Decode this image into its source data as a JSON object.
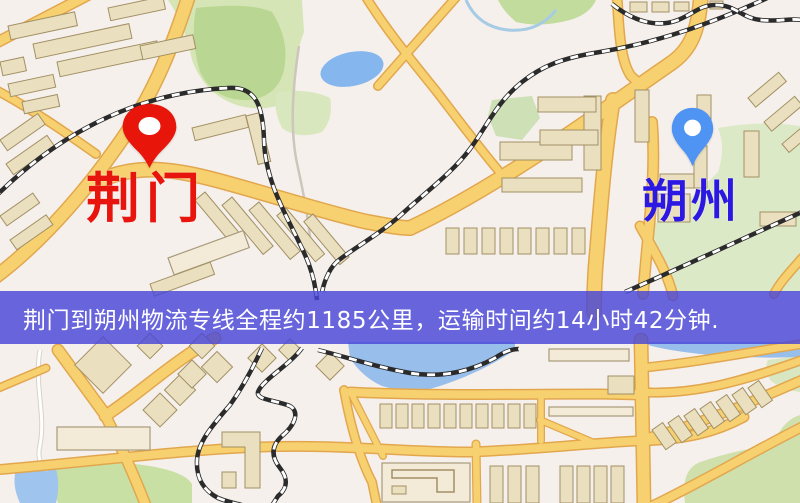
{
  "banner": {
    "text": "荆门到朔州物流专线全程约1185公里，运输时间约14小时42分钟.",
    "background_color": "rgba(72,70,216,0.82)",
    "text_color": "#ffffff"
  },
  "markers": {
    "origin": {
      "label": "荆门",
      "pin_color": "#e8150a",
      "label_color": "#e8150e"
    },
    "destination": {
      "label": "朔州",
      "pin_color": "#4f93f3",
      "label_color": "#2b18e2"
    }
  },
  "map": {
    "colors": {
      "background": "#f6f0ec",
      "road_fill": "#f7d170",
      "road_casing": "#e2a74e",
      "railway": "#2b2b2b",
      "water": "#98bfec",
      "green": "#c3dc9c",
      "building": "#eae0bf"
    }
  }
}
